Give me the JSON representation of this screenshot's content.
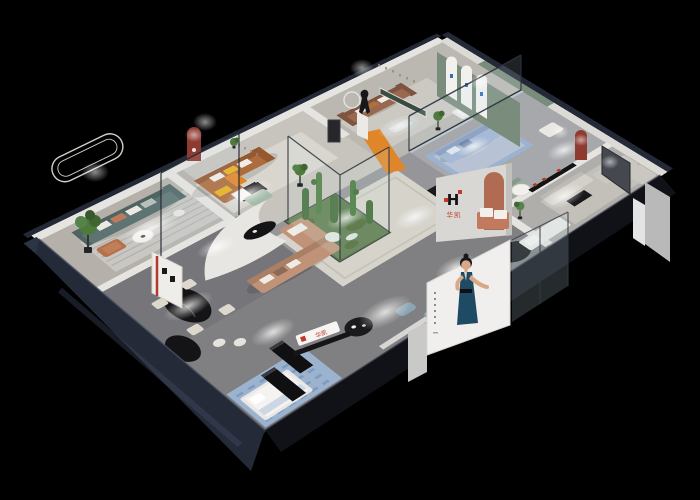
{
  "meta": {
    "background": "#000000",
    "description": "Isometric cutaway 3D render of a furniture brand showroom interior at night"
  },
  "brand": {
    "logo_letter": "H",
    "name_cn": "华凯",
    "partition_sign": "华凯",
    "reception_sign": "华凯"
  },
  "poster": {
    "subject": "fashion model in dark blue evening gown",
    "panel_color": "#f0efed",
    "dress_color": "#1e4a63"
  },
  "palette": {
    "backdrop": "#000000",
    "navy_wall": "#242a38",
    "wall_cap": "#232936",
    "wall_face": "#e6e4e0",
    "floor_base": "#87878a",
    "floor_warm": "#b5b1aa",
    "floor_light": "#c7c4be",
    "floor_mid": "#bbb8b2",
    "floor_cool": "#a7a8ab",
    "floor_dark": "#76767a",
    "floor_entry": "#808082",
    "teal_sofa": "#5d7472",
    "caramel_sofa": "#ad6b3e",
    "brown_sofa": "#99684e",
    "blush_sofa": "#c09378",
    "blue_sofa": "#a6b9d5",
    "sage_sofa": "#9bafa0",
    "grey_sofa": "#d3d0ca",
    "orange_accent": "#e0862a",
    "red_arch": "#8e3a30",
    "terracotta": "#b26b53",
    "green_wall": "#7a8c7b",
    "garden_green": "#5c7a4c",
    "glass_tint": "#cfe6f0",
    "rug_blue": "#9cb3cf",
    "pouf_blue": "#8ba4b2",
    "logo_red": "#c0392b",
    "logo_black": "#141414"
  },
  "rooms": [
    {
      "name": "teal-sofa-lounge"
    },
    {
      "name": "caramel-sofa-lounge"
    },
    {
      "name": "statue-gallery-corridor"
    },
    {
      "name": "brown-sofa-lounge"
    },
    {
      "name": "arched-green-wall-lounge"
    },
    {
      "name": "grey-sofa-showroom"
    },
    {
      "name": "center-lounge-with-cactus-garden"
    },
    {
      "name": "dining-display"
    },
    {
      "name": "entry-reception"
    },
    {
      "name": "bed-display"
    }
  ]
}
